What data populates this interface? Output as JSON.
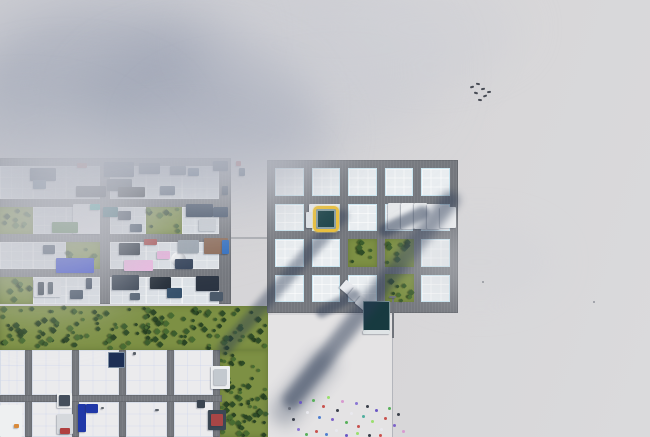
{
  "scene": {
    "width": 650,
    "height": 437,
    "terrain_color": "#d7d6d8",
    "road_color": "#74777d",
    "plaza": {
      "x": 268,
      "y": 315,
      "w": 124,
      "h": 122,
      "color": "#e4e3e4"
    },
    "boundary_line": {
      "x": 392,
      "y": 315,
      "h": 122,
      "color": "#a5a8af"
    },
    "path_stub": {
      "x": 231,
      "y": 237,
      "w": 36,
      "h": 2,
      "color": "#a9abaf"
    }
  },
  "selection_marker": {
    "x": 313,
    "y": 206,
    "size": 26,
    "border_color": "#e9bf3d",
    "fill_color": "#20464b"
  },
  "grids": {
    "right": {
      "x": 267,
      "y": 160,
      "w": 191,
      "h": 153,
      "cols": 5,
      "rows": 4,
      "cell_w": 28.6,
      "cell_h": 27.5,
      "road_w": 8
    },
    "left": {
      "x": 0,
      "y": 158,
      "w": 231,
      "h": 146,
      "lot_cols": [
        [
          0,
          33
        ],
        [
          33,
          33
        ],
        [
          66,
          34
        ],
        [
          110,
          36
        ],
        [
          146,
          36
        ],
        [
          182,
          37
        ]
      ],
      "lot_rows": [
        [
          166,
          33
        ],
        [
          207,
          27
        ],
        [
          242,
          27
        ],
        [
          277,
          27
        ]
      ]
    },
    "lower": {
      "vroads": [
        [
          25,
          7
        ],
        [
          72,
          7
        ],
        [
          119,
          7
        ],
        [
          167,
          7
        ],
        [
          213,
          7
        ]
      ],
      "vroad_y": 350,
      "vroad_h": 87,
      "hroad": [
        395,
        7
      ],
      "hroad_x": 0,
      "hroad_w": 222,
      "lot_cols": [
        [
          0,
          25
        ],
        [
          32,
          40
        ],
        [
          79,
          40
        ],
        [
          126,
          41
        ],
        [
          174,
          39
        ]
      ],
      "lot_rows": [
        [
          350,
          45
        ],
        [
          402,
          35
        ]
      ]
    }
  },
  "vegetation": {
    "band_color": "#7d9044",
    "tree_palette": [
      "#2f4c27",
      "#3c5d2d",
      "#486b31",
      "#2a4423"
    ],
    "areas": [
      {
        "x": 0,
        "y": 306,
        "w": 268,
        "h": 44,
        "trees": 150
      },
      {
        "x": 220,
        "y": 350,
        "w": 48,
        "h": 87,
        "trees": 66
      },
      {
        "x": 0,
        "y": 207,
        "w": 33,
        "h": 27,
        "trees": 9
      },
      {
        "x": 146,
        "y": 207,
        "w": 36,
        "h": 27,
        "trees": 9
      },
      {
        "x": 66,
        "y": 242,
        "w": 34,
        "h": 27,
        "trees": 8
      },
      {
        "x": 0,
        "y": 277,
        "w": 33,
        "h": 27,
        "trees": 8
      },
      {
        "x": 348,
        "y": 239,
        "w": 29,
        "h": 28,
        "trees": 9
      },
      {
        "x": 385,
        "y": 239,
        "w": 29,
        "h": 28,
        "trees": 9
      },
      {
        "x": 385,
        "y": 274,
        "w": 29,
        "h": 28,
        "trees": 9
      }
    ]
  },
  "structures": [
    [
      "box",
      30,
      168,
      26,
      13,
      "#2c3e57"
    ],
    [
      "box",
      33,
      180,
      13,
      9,
      "#45607c"
    ],
    [
      "box",
      77,
      163,
      10,
      5,
      "#a83a3a"
    ],
    [
      "box",
      76,
      186,
      30,
      11,
      "#2b3340"
    ],
    [
      "box",
      104,
      162,
      30,
      15,
      "#22344e"
    ],
    [
      "box",
      107,
      179,
      25,
      12,
      "#3a4654"
    ],
    [
      "box",
      118,
      187,
      27,
      10,
      "#1e242c"
    ],
    [
      "box",
      139,
      163,
      21,
      11,
      "#30425a"
    ],
    [
      "box",
      160,
      186,
      15,
      9,
      "#56657a"
    ],
    [
      "box",
      170,
      166,
      16,
      9,
      "#49596c"
    ],
    [
      "box",
      188,
      168,
      11,
      8,
      "#2e4a6b"
    ],
    [
      "box",
      213,
      161,
      15,
      10,
      "#2a3b52"
    ],
    [
      "box",
      222,
      186,
      6,
      9,
      "#3b4a5e"
    ],
    [
      "box",
      236,
      161,
      5,
      5,
      "#b03a3a"
    ],
    [
      "box",
      239,
      168,
      6,
      8,
      "#2e4560"
    ],
    [
      "box",
      73,
      204,
      27,
      30,
      "#f1f2f4",
      "large-white-building"
    ],
    [
      "box",
      90,
      204,
      10,
      6,
      "#2aa7a0"
    ],
    [
      "box",
      52,
      222,
      26,
      11,
      "#4a7a44"
    ],
    [
      "box",
      103,
      207,
      15,
      10,
      "#23606b"
    ],
    [
      "box",
      118,
      211,
      13,
      9,
      "#2f3c4e"
    ],
    [
      "box",
      186,
      204,
      27,
      13,
      "#293a52"
    ],
    [
      "box",
      199,
      219,
      17,
      12,
      "#ccd2d8"
    ],
    [
      "box",
      213,
      207,
      15,
      10,
      "#31435c"
    ],
    [
      "box",
      130,
      224,
      12,
      8,
      "#3c4c60"
    ],
    [
      "box",
      56,
      258,
      38,
      15,
      "#2b3fd0",
      "blue-warehouse"
    ],
    [
      "box",
      124,
      260,
      29,
      11,
      "#efb9e3"
    ],
    [
      "box",
      157,
      251,
      13,
      8,
      "#e8b4dd"
    ],
    [
      "sphere",
      171,
      252,
      15,
      15,
      "#eef0f2",
      "storage-tank"
    ],
    [
      "box",
      178,
      240,
      21,
      13,
      "#9aa4ae"
    ],
    [
      "box",
      204,
      238,
      24,
      16,
      "#8a6752"
    ],
    [
      "box",
      175,
      259,
      18,
      10,
      "#324158"
    ],
    [
      "box",
      144,
      239,
      13,
      6,
      "#a84848"
    ],
    [
      "box",
      119,
      243,
      21,
      12,
      "#27313d"
    ],
    [
      "box",
      43,
      245,
      12,
      9,
      "#3e4e62"
    ],
    [
      "box",
      222,
      240,
      7,
      14,
      "#2b6bc0"
    ],
    [
      "box",
      34,
      279,
      27,
      18,
      "#e2e5e9"
    ],
    [
      "box",
      38,
      282,
      6,
      13,
      "#3c4754"
    ],
    [
      "box",
      48,
      282,
      5,
      12,
      "#4a5663"
    ],
    [
      "box",
      112,
      275,
      27,
      15,
      "#343f4e"
    ],
    [
      "box",
      150,
      277,
      21,
      12,
      "#222b36"
    ],
    [
      "box",
      167,
      288,
      15,
      10,
      "#35506b"
    ],
    [
      "box",
      196,
      276,
      23,
      15,
      "#2b3442"
    ],
    [
      "box",
      210,
      292,
      13,
      9,
      "#4c5a6a"
    ],
    [
      "box",
      70,
      290,
      13,
      9,
      "#3d4c5e"
    ],
    [
      "box",
      86,
      278,
      6,
      11,
      "#39465a"
    ],
    [
      "box",
      130,
      293,
      10,
      7,
      "#515f6f"
    ],
    [
      "solar",
      108,
      352,
      17,
      16,
      "#1d2f55",
      "solar-panel"
    ],
    [
      "box",
      211,
      366,
      19,
      23,
      "#eceef0"
    ],
    [
      "box",
      214,
      369,
      13,
      16,
      "#c3c9cf"
    ],
    [
      "stripes",
      0,
      405,
      22,
      32,
      "#eef0f1"
    ],
    [
      "box",
      14,
      424,
      5,
      4,
      "#d98a3a"
    ],
    [
      "box",
      57,
      393,
      15,
      15,
      "#edeff0"
    ],
    [
      "box",
      59,
      395,
      11,
      11,
      "#454f5c"
    ],
    [
      "box",
      78,
      404,
      8,
      28,
      "#2038a8",
      "blue-building"
    ],
    [
      "box",
      86,
      404,
      12,
      9,
      "#2038a8"
    ],
    [
      "box",
      57,
      414,
      16,
      20,
      "#d6d9dd"
    ],
    [
      "box",
      60,
      428,
      10,
      6,
      "#b04040"
    ],
    [
      "box",
      208,
      410,
      18,
      20,
      "#3c4854"
    ],
    [
      "box",
      211,
      414,
      12,
      12,
      "#a84646"
    ],
    [
      "box",
      197,
      400,
      8,
      8,
      "#3a4450"
    ],
    [
      "box",
      133,
      352,
      3,
      3,
      "#5a6068"
    ],
    [
      "box",
      101,
      407,
      3,
      2,
      "#62686f"
    ],
    [
      "box",
      155,
      409,
      4,
      2,
      "#596068"
    ],
    [
      "saw",
      388,
      203,
      13,
      26,
      "#e6e8ea",
      "factory-building"
    ],
    [
      "saw",
      401,
      203,
      13,
      26,
      "#eceef0",
      "factory-building"
    ],
    [
      "saw",
      414,
      203,
      13,
      26,
      "#e9ebed",
      "factory-building"
    ],
    [
      "saw",
      427,
      204,
      13,
      25,
      "#f0f1f3",
      "factory-building"
    ],
    [
      "box",
      440,
      207,
      16,
      21,
      "#eef0f2",
      "factory-building"
    ],
    [
      "box",
      309,
      204,
      30,
      13,
      "#e9ebee",
      "selected-lot-building"
    ],
    [
      "box",
      306,
      212,
      8,
      16,
      "#dfe3e7"
    ],
    [
      "saw",
      341,
      283,
      15,
      11,
      "#e8eaee",
      "warehouse",
      40
    ],
    [
      "saw",
      349,
      291,
      16,
      11,
      "#edeff1",
      "warehouse",
      40
    ],
    [
      "saw",
      356,
      299,
      15,
      10,
      "#e4e7ea",
      "warehouse",
      40
    ],
    [
      "solar",
      363,
      301,
      27,
      31,
      "#173a40",
      "solar-roof-building"
    ],
    [
      "box",
      363,
      330,
      27,
      4,
      "#dfe4e6"
    ],
    [
      "pole",
      392,
      296,
      2,
      42,
      "#70747b",
      "street-lamp"
    ],
    [
      "box",
      389,
      296,
      7,
      2,
      "#70747b"
    ]
  ],
  "shadows": {
    "color": "#2b3a54",
    "bands": [
      [
        371,
        300,
        272,
        18,
        128.5,
        0.5,
        4
      ],
      [
        303,
        388,
        85,
        26,
        128.5,
        0.32,
        8
      ],
      [
        283,
        282,
        190,
        14,
        131.3,
        0.42,
        3
      ],
      [
        404,
        221,
        54,
        13,
        155,
        0.5,
        2
      ],
      [
        338,
        303,
        48,
        11,
        152,
        0.45,
        2
      ]
    ]
  },
  "smoke": {
    "blobs": [
      [
        190,
        70,
        240,
        120,
        "#c7c9d0",
        0.55,
        30
      ],
      [
        95,
        35,
        150,
        70,
        "#bfc2cb",
        0.5,
        24
      ],
      [
        115,
        90,
        140,
        80,
        "#a6abba",
        0.6,
        22
      ],
      [
        195,
        105,
        115,
        70,
        "#9ca3b4",
        0.55,
        20
      ],
      [
        62,
        132,
        115,
        68,
        "#aab0bd",
        0.55,
        22
      ],
      [
        240,
        135,
        95,
        60,
        "#b4b8c4",
        0.5,
        20
      ],
      [
        25,
        195,
        125,
        85,
        "#c3c5cd",
        0.5,
        26
      ],
      [
        160,
        185,
        150,
        65,
        "#c8cad1",
        0.38,
        22
      ],
      [
        340,
        45,
        150,
        65,
        "#cccdd4",
        0.45,
        24
      ],
      [
        430,
        28,
        95,
        45,
        "#d1d2d7",
        0.4,
        20
      ],
      [
        480,
        262,
        75,
        38,
        "#d2d3d8",
        0.38,
        18
      ],
      [
        45,
        255,
        105,
        65,
        "#cbccd3",
        0.4,
        24
      ]
    ]
  },
  "pedestrians": [
    [
      299,
      401,
      "#6a57c4"
    ],
    [
      306,
      411,
      "#e9e9ee"
    ],
    [
      312,
      399,
      "#58b05a"
    ],
    [
      318,
      416,
      "#4f7fd0"
    ],
    [
      322,
      405,
      "#c8524e"
    ],
    [
      327,
      396,
      "#9adf6e"
    ],
    [
      331,
      418,
      "#7d62c9"
    ],
    [
      336,
      409,
      "#3a3f4a"
    ],
    [
      341,
      400,
      "#d89ad0"
    ],
    [
      345,
      421,
      "#58b05a"
    ],
    [
      350,
      412,
      "#e9e9ee"
    ],
    [
      355,
      402,
      "#8a76d4"
    ],
    [
      357,
      425,
      "#c8524e"
    ],
    [
      362,
      415,
      "#4fae9e"
    ],
    [
      366,
      405,
      "#3a3f4a"
    ],
    [
      371,
      420,
      "#9adf6e"
    ],
    [
      375,
      409,
      "#6a57c4"
    ],
    [
      380,
      428,
      "#e9e9ee"
    ],
    [
      384,
      417,
      "#c8524e"
    ],
    [
      388,
      407,
      "#58b05a"
    ],
    [
      393,
      424,
      "#7d62c9"
    ],
    [
      397,
      413,
      "#3a3f4a"
    ],
    [
      402,
      430,
      "#d89ad0"
    ],
    [
      292,
      418,
      "#3a3f4a"
    ],
    [
      297,
      428,
      "#8a76d4"
    ],
    [
      305,
      433,
      "#58b05a"
    ],
    [
      315,
      430,
      "#c8524e"
    ],
    [
      325,
      433,
      "#4f7fd0"
    ],
    [
      335,
      429,
      "#e9e9ee"
    ],
    [
      345,
      434,
      "#6a57c4"
    ],
    [
      356,
      432,
      "#9adf6e"
    ],
    [
      368,
      434,
      "#3a3f4a"
    ],
    [
      288,
      407,
      "#666c78"
    ],
    [
      379,
      434,
      "#c8524e"
    ]
  ],
  "birds": [
    [
      470,
      86,
      -15
    ],
    [
      476,
      83,
      10
    ],
    [
      481,
      88,
      -10
    ],
    [
      474,
      92,
      15
    ],
    [
      483,
      95,
      -18
    ],
    [
      478,
      99,
      8
    ],
    [
      487,
      91,
      -5
    ]
  ],
  "specks": [
    [
      482,
      281
    ],
    [
      593,
      301
    ]
  ]
}
